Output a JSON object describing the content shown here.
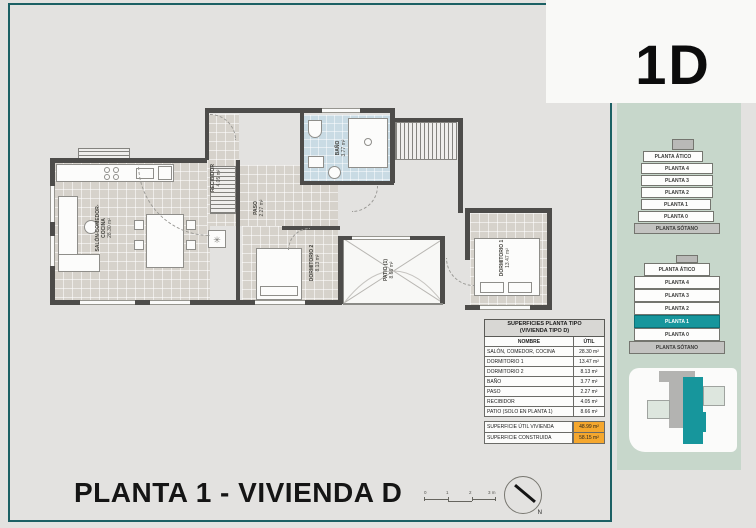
{
  "header": {
    "unit_code": "1D"
  },
  "sheet_title": "PLANTA 1 - VIVIENDA D",
  "plan": {
    "rooms": [
      {
        "name": "SALÓN-COMEDOR-COCINA",
        "area": "28.30 m²"
      },
      {
        "name": "RECIBIDOR",
        "area": "4.05 m²"
      },
      {
        "name": "BAÑO",
        "area": "3.77 m²"
      },
      {
        "name": "PASO",
        "area": "2.27 m²"
      },
      {
        "name": "DORMITORIO 2",
        "area": "8.13 m²"
      },
      {
        "name": "PATIO (1)",
        "area": "8.66 m²"
      },
      {
        "name": "DORMITORIO 1",
        "area": "13.47 m²"
      }
    ]
  },
  "surfaces_table": {
    "title_line1": "SUPERFICIES PLANTA TIPO",
    "title_line2": "(VIVIENDA TIPO D)",
    "col_name": "NOMBRE",
    "col_util": "ÚTIL",
    "rows": [
      {
        "name": "SALÓN, COMEDOR, COCINA",
        "util": "28.30 m²"
      },
      {
        "name": "DORMITORIO 1",
        "util": "13.47 m²"
      },
      {
        "name": "DORMITORIO 2",
        "util": "8.13 m²"
      },
      {
        "name": "BAÑO",
        "util": "3.77 m²"
      },
      {
        "name": "PASO",
        "util": "2.27 m²"
      },
      {
        "name": "RECIBIDOR",
        "util": "4.05 m²"
      },
      {
        "name": "PATIO (SOLO EN PLANTA 1)",
        "util": "8.66 m²"
      }
    ],
    "totals": [
      {
        "name": "SUPERFICIE ÚTIL VIVIENDA",
        "util": "48.99 m²"
      },
      {
        "name": "SUPERFICIE CONSTRUIDA",
        "util": "58.15 m²"
      }
    ],
    "highlight_color": "#F5A72E"
  },
  "sidebar": {
    "panel_color": "#C7D7CB",
    "highlight_color": "#17969C",
    "stack_upper": {
      "floors": [
        "PLANTA ÁTICO",
        "PLANTA 4",
        "PLANTA 3",
        "PLANTA 2",
        "PLANTA 1",
        "PLANTA 0",
        "PLANTA SÓTANO"
      ]
    },
    "stack_lower": {
      "floors": [
        "PLANTA ÁTICO",
        "PLANTA 4",
        "PLANTA 3",
        "PLANTA 2",
        "PLANTA 1",
        "PLANTA 0",
        "PLANTA SÓTANO"
      ],
      "highlighted_floor": "PLANTA 1"
    }
  },
  "scale_bar": {
    "labels": [
      "0",
      "1",
      "2",
      "3 m"
    ]
  },
  "compass": {
    "label": "N"
  }
}
